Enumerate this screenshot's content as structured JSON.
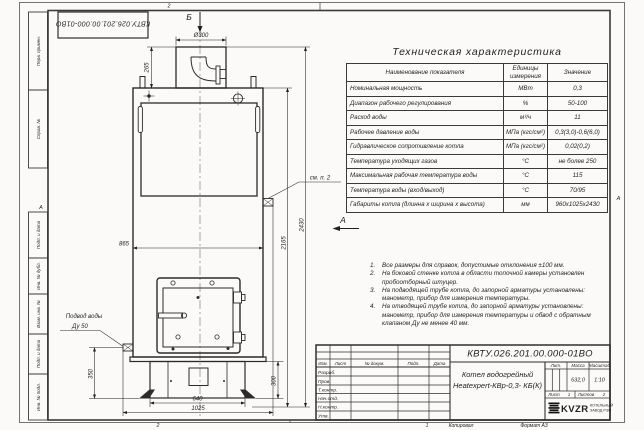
{
  "sheet": {
    "doc_number_top": "КВТУ.026.201.00.000-01ВО",
    "zone_top": "2",
    "zone_bottom_left": "2",
    "zone_bottom_right": "1",
    "zone_left": "А",
    "zone_right": "А",
    "copied_label": "Копировал",
    "format_label": "Формат А3",
    "margin_boxes": [
      "Перв. примен.",
      "Справ. №",
      "Подп. и дата",
      "Инв. № дубл.",
      "Взам. инв. №",
      "Подп. и дата",
      "Инв. № подл."
    ]
  },
  "spec_table": {
    "title": "Техническая характеристика",
    "col_name": "Наименование показателя",
    "col_units": "Единицы измерения",
    "col_value": "Значение",
    "rows": [
      {
        "name": "Номинальная мощность",
        "unit": "МВт",
        "value": "0,3"
      },
      {
        "name": "Диапазон рабочего регулирования",
        "unit": "%",
        "value": "50-100"
      },
      {
        "name": "Расход воды",
        "unit": "м³/ч",
        "value": "11"
      },
      {
        "name": "Рабочее давление воды",
        "unit": "МПа (кгс/см²)",
        "value": "0,3(3,0)-0,6(6,0)"
      },
      {
        "name": "Гидравлическое сопротивление котла",
        "unit": "МПа (кгс/см²)",
        "value": "0,02(0,2)"
      },
      {
        "name": "Температура уходящих газов",
        "unit": "°С",
        "value": "не более 250"
      },
      {
        "name": "Максимальная рабочая температура воды",
        "unit": "°С",
        "value": "115"
      },
      {
        "name": "Температура воды (вход/выход)",
        "unit": "°С",
        "value": "70/95"
      },
      {
        "name": "Габариты котла (длинна х ширина х высота)",
        "unit": "мм",
        "value": "960х1025х2430"
      }
    ]
  },
  "notes": {
    "items": [
      {
        "num": "1.",
        "text": "Все размеры для справок, допустимые отклонения ±100 мм."
      },
      {
        "num": "2.",
        "text": "На боковой стенке котла в области топочной камеры установлен пробоотборный штуцер."
      },
      {
        "num": "3.",
        "text": "На подводящей трубе котла, до запорной арматуры установлены: манометр, прибор для измерения температуры."
      },
      {
        "num": "4.",
        "text": "На отводящей трубе котла, до запорной арматуры установлены: манометр, прибор для измерения температуры и обвод с обратным клапаном Ду не менее 40 мм."
      }
    ]
  },
  "drawing": {
    "view_b": "Б",
    "view_a": "А",
    "callout_note2": "см. п. 2",
    "inlet_label_1": "Подвод воды",
    "inlet_label_2": "Ду 50",
    "dim_diameter": "Ø300",
    "dim_stub_height": "265",
    "dim_body_width": "865",
    "dim_total_height": "2430",
    "dim_body_height": "2165",
    "dim_inlet_height": "350",
    "dim_base_height": "300",
    "dim_base_width": "640",
    "dim_overall_width": "1025"
  },
  "title_block": {
    "doc_number": "КВТУ.026.201.00.000-01ВО",
    "name_line1": "Котел водогрейный",
    "name_line2": "Heatexpert-КВр-0,3- КБ(К)",
    "col_izm": "Изм.",
    "col_list": "Лист",
    "col_doc": "№ докум.",
    "col_sign": "Подп.",
    "col_date": "Дата",
    "rows": [
      "Разраб.",
      "Пров.",
      "Т.контр.",
      "Нач.отд.",
      "Н.контр.",
      "Утв."
    ],
    "lit_label": "Лит.",
    "mass_label": "Масса",
    "scale_label": "Масштаб",
    "mass_value": "632,0",
    "scale_value": "1:10",
    "sheet_label": "Лист",
    "sheet_value": "1",
    "sheets_label": "Листов",
    "sheets_value": "2",
    "logo_text": "KVZR",
    "company_line1": "КОТЕЛЬНЫЙ",
    "company_line2": "ЗАВОД РЭП"
  }
}
